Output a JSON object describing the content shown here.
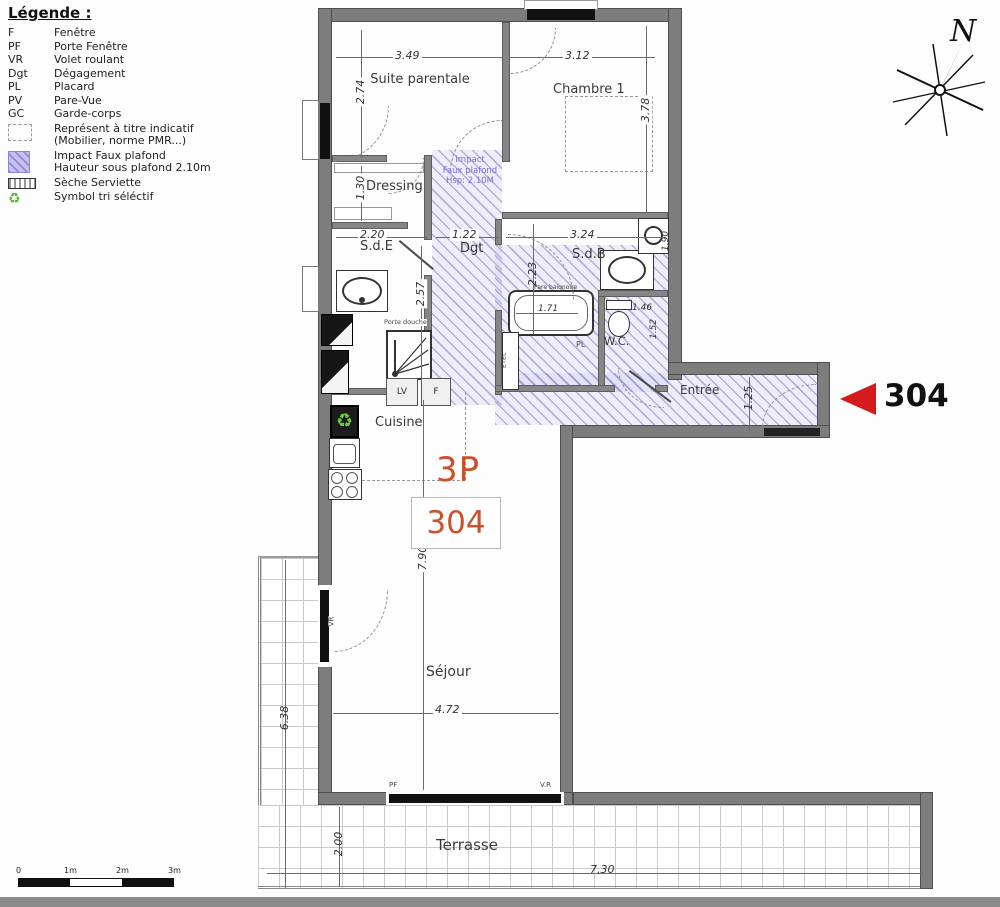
{
  "legend": {
    "title": "Légende :",
    "abbreviations": [
      {
        "abbr": "F",
        "label": "Fenêtre"
      },
      {
        "abbr": "PF",
        "label": "Porte Fenêtre"
      },
      {
        "abbr": "VR",
        "label": "Volet roulant"
      },
      {
        "abbr": "Dgt",
        "label": "Dégagement"
      },
      {
        "abbr": "PL",
        "label": "Placard"
      },
      {
        "abbr": "PV",
        "label": "Pare-Vue"
      },
      {
        "abbr": "GC",
        "label": "Garde-corps"
      }
    ],
    "symbols": [
      {
        "line1": "Représent à titre indicatif",
        "line2": "(Mobilier, norme PMR...)"
      },
      {
        "line1": "Impact Faux plafond",
        "line2": "Hauteur sous plafond 2.10m"
      },
      {
        "line1": "Sèche Serviette"
      },
      {
        "line1": "Symbol tri séléctif"
      }
    ]
  },
  "compass": {
    "north": "N"
  },
  "unit": {
    "type": "3P",
    "number": "304"
  },
  "marker": {
    "number": "304"
  },
  "rooms": {
    "suite": "Suite parentale",
    "chambre": "Chambre 1",
    "dressing": "Dressing",
    "sde": "S.d.E",
    "dgt": "Dgt",
    "sdb": "S.d.B",
    "wc": "W.C.",
    "entree": "Entrée",
    "cuisine": "Cuisine",
    "sejour": "Séjour",
    "terrasse": "Terrasse"
  },
  "dims": {
    "suite_w": "3.49",
    "suite_h": "2.74",
    "chambre_w": "3.12",
    "chambre_h": "3.78",
    "dressing_h": "1.30",
    "sde_w": "2.20",
    "sde_h": "2.57",
    "dgt_w": "1.22",
    "sdb_w": "3.24",
    "sdb_h": "2.23",
    "sdb_side": "1.90",
    "bath_w": "1.71",
    "wc_w": "1.46",
    "wc_h": "1.52",
    "entree_h": "1.25",
    "sejour_h": "7.90",
    "sejour_w": "4.72",
    "terrasse_left_h": "6.38",
    "terrasse_bottom_h": "2.00",
    "terrasse_w": "7.30"
  },
  "annotations": {
    "impact_l1": "Impact",
    "impact_l2": "Faux plafond",
    "impact_l3": "Hsp: 2.10M",
    "porte_douche": "Porte douche",
    "pare_baignoire": "Pare baignoire",
    "pl": "PL",
    "etel": "ETEL",
    "lv": "LV",
    "f": "F",
    "vr": "VR",
    "pf": "PF",
    "vr2": "V.R",
    "recycle_icon": "♻"
  },
  "scale_bar": {
    "ticks": [
      "0",
      "1m",
      "2m",
      "3m"
    ]
  }
}
